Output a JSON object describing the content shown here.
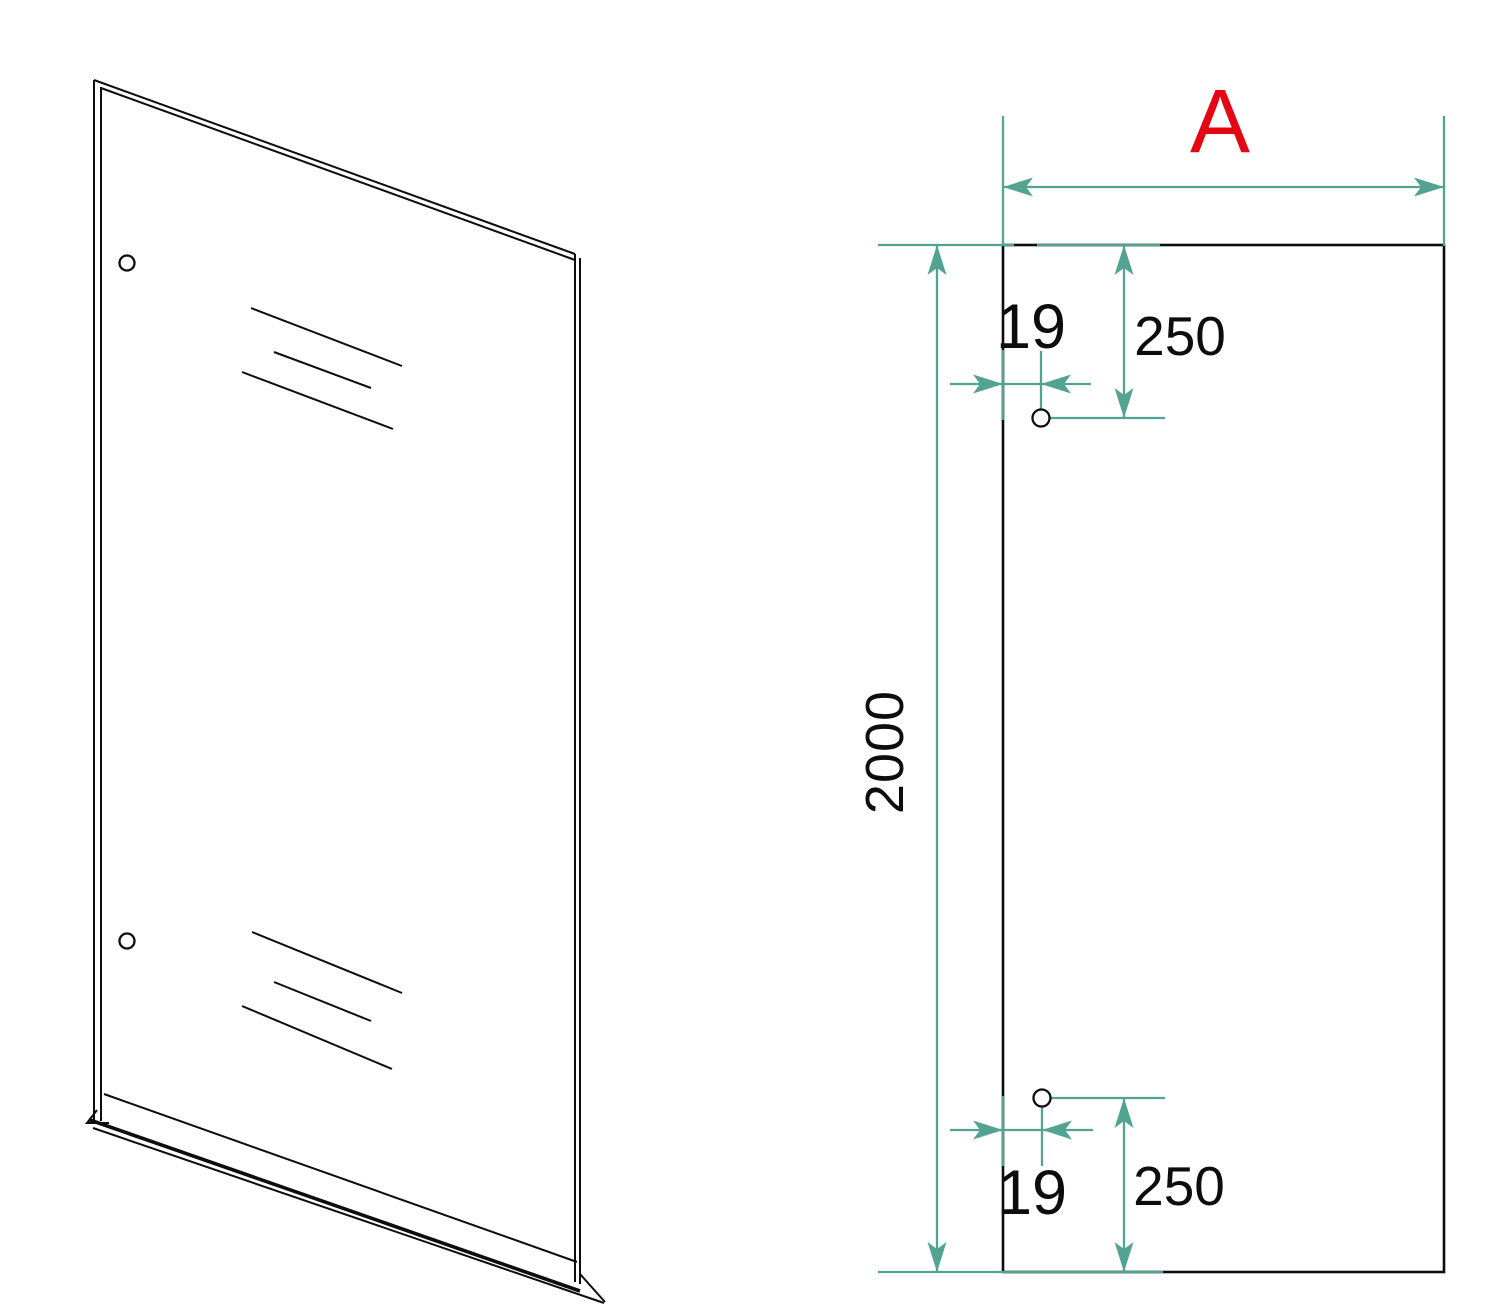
{
  "labels": {
    "width": "A",
    "height": "2000",
    "top_hole": {
      "edge_offset": "19",
      "top_offset": "250"
    },
    "bottom_hole": {
      "edge_offset": "19",
      "bottom_offset": "250"
    }
  },
  "colors": {
    "dimension": "#52a392",
    "highlight": "#e30613",
    "line": "#0d0d0d",
    "background": "#ffffff"
  }
}
